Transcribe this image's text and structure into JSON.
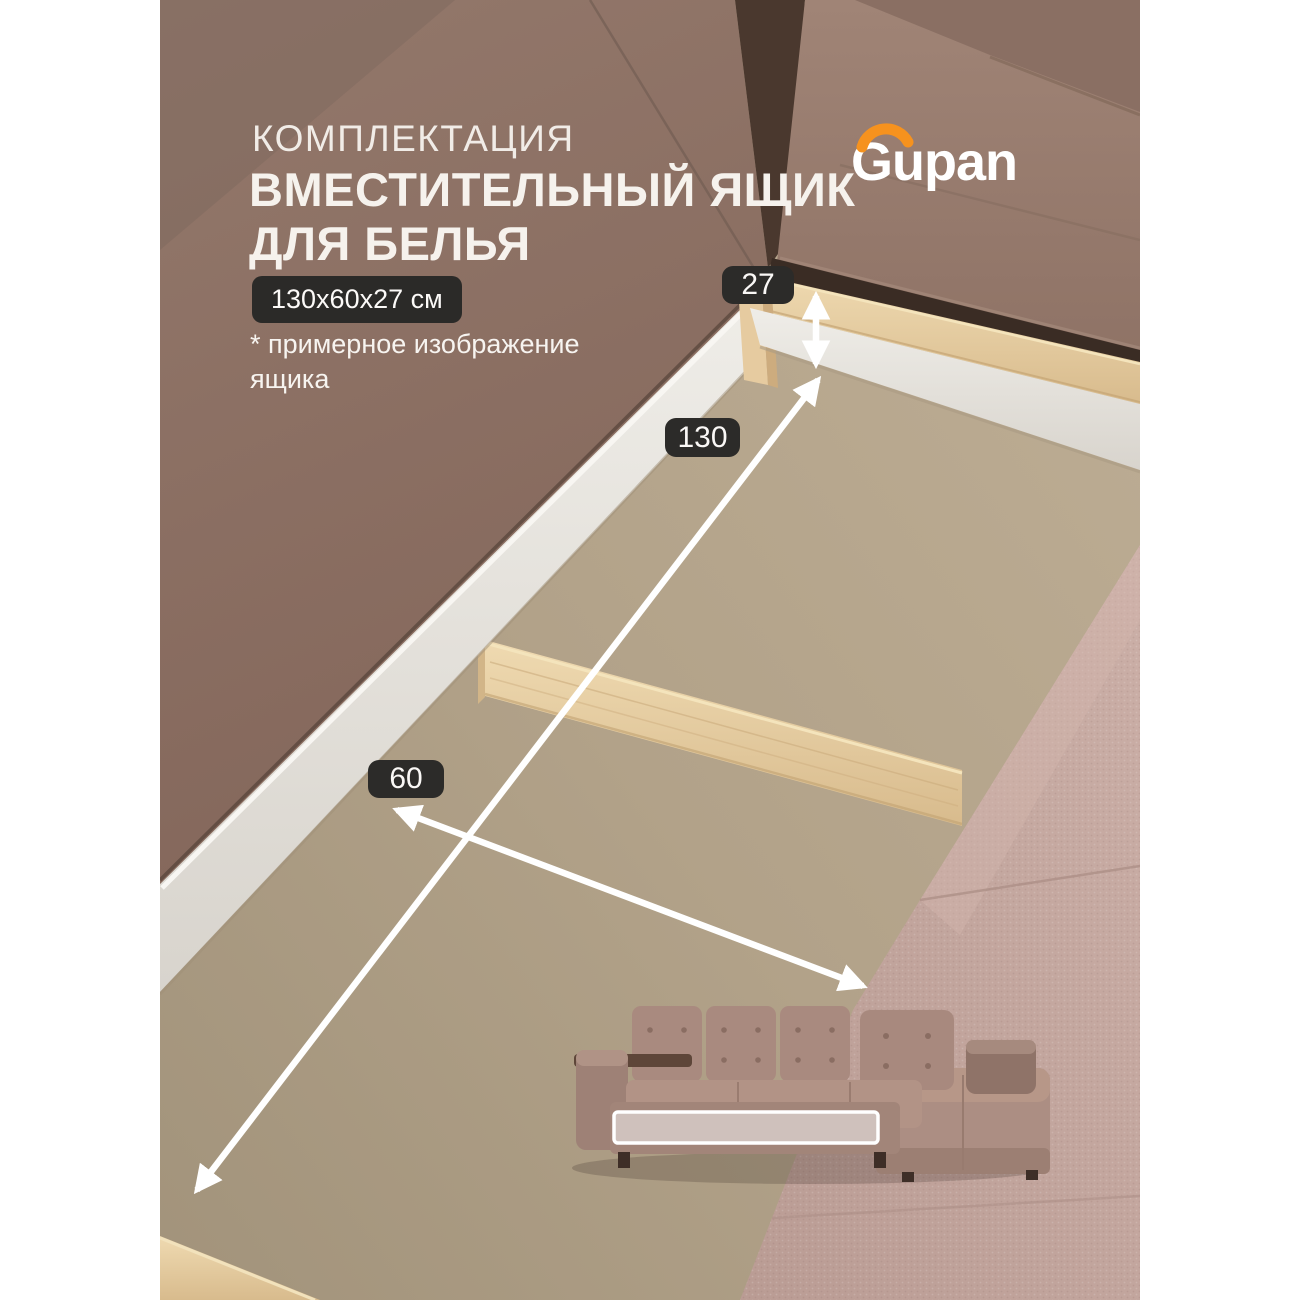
{
  "header": {
    "kicker": "КОМПЛЕКТАЦИЯ",
    "title_line1": "ВМЕСТИТЕЛЬНЫЙ ЯЩИК",
    "title_line2": "ДЛЯ БЕЛЬЯ",
    "size_badge": "130x60x27 см",
    "footnote_line1": "* примерное изображение",
    "footnote_line2": "ящика"
  },
  "brand": {
    "logo_text": "Gupan"
  },
  "measurements": {
    "height_cm": "27",
    "length_cm": "130",
    "depth_cm": "60"
  },
  "colors": {
    "accent_orange": "#F6921E",
    "badge_bg": "#2B2A28",
    "overlay_text": "#F4F0EB",
    "sofa_brown": "#8C7165",
    "box_floor": "#B2A289",
    "wood_oak": "#E2C89C",
    "chaise_pink": "#C2A59D"
  }
}
